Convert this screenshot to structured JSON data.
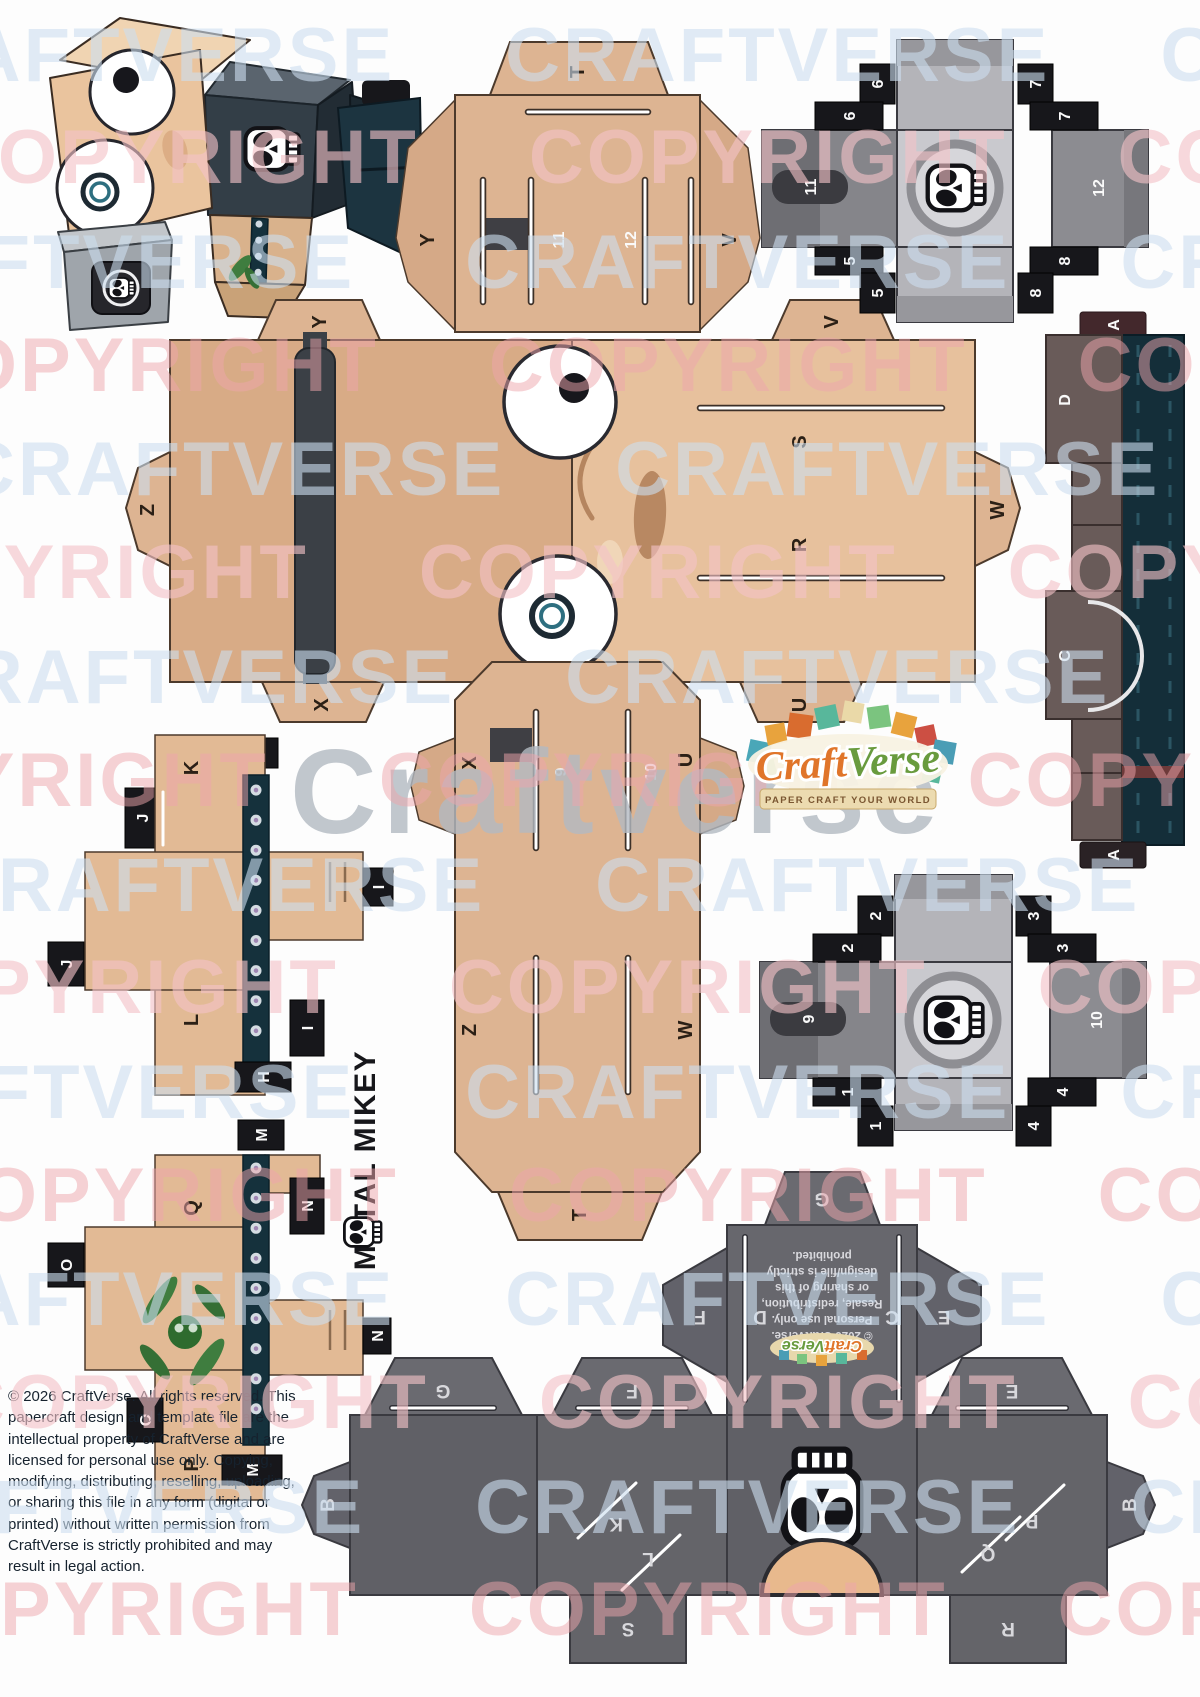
{
  "watermark": {
    "craftverse": "CRAFTVERSE",
    "copyright": "COPYRIGHT",
    "center": "Craftverse"
  },
  "title": "METAL MIKEY",
  "logo": {
    "craft": "Craft",
    "verse": "Verse",
    "tagline": "PAPER CRAFT YOUR WORLD"
  },
  "footer": {
    "copyright": "© 2026 CraftVerse. All rights reserved. This papercraft design and template file are the intellectual property of CraftVerse and are licensed for personal use only. Copying, modifying, distributing, reselling, uploading, or sharing this file in any form (digital or printed) without written permission from CraftVerse is strictly prohibited and may result in legal action."
  },
  "pieces": {
    "head_top": {
      "tab_t": "T",
      "tab_y": "Y",
      "tab_v": "V",
      "slot_11": "11",
      "slot_12": "12"
    },
    "head_band": {
      "tab_t": "T",
      "label_x": "X",
      "label_u": "U",
      "label_z": "Z",
      "label_w": "W",
      "slot_9": "9",
      "slot_10": "10"
    },
    "face": {
      "tab_y": "Y",
      "tab_z": "Z",
      "tab_x": "X",
      "tab_v": "V",
      "tab_u": "U",
      "tab_w": "W",
      "slit_s": "S",
      "slit_r": "R"
    },
    "cube_upper": {
      "slot": "11",
      "right_face": "12",
      "tab_5a": "5",
      "tab_5b": "5",
      "tab_6a": "6",
      "tab_6b": "6",
      "tab_7a": "7",
      "tab_7b": "7",
      "tab_8a": "8",
      "tab_8b": "8"
    },
    "cube_lower": {
      "slot": "9",
      "right_face": "10",
      "tab_1a": "1",
      "tab_1b": "1",
      "tab_2a": "2",
      "tab_2b": "2",
      "tab_3a": "3",
      "tab_3b": "3",
      "tab_4a": "4",
      "tab_4b": "4"
    },
    "strip": {
      "tab_a_top": "A",
      "label_d": "D",
      "label_c": "C",
      "tab_a_bottom": "A"
    },
    "arm_upper": {
      "label_k": "K",
      "label_l": "L",
      "tab_h_top": "H",
      "tab_h_bottom": "H",
      "tab_j_top": "J",
      "tab_j_left": "J",
      "tab_i_right": "I",
      "tab_i_bottom": "I"
    },
    "arm_lower": {
      "label_q": "Q",
      "label_p": "P",
      "tab_m_top": "M",
      "tab_m_bottom": "M",
      "tab_n_left": "N",
      "tab_n_right": "N",
      "tab_o_left": "O",
      "tab_o_bottom": "O"
    },
    "body": {
      "tab_g": "G",
      "flap_g": "G",
      "flap_f": "F",
      "side_f": "F",
      "flap_e": "E",
      "side_e": "E",
      "label_d": "D",
      "label_c": "C",
      "tab_b_left": "B",
      "tab_b_right": "B",
      "slit_k": "K",
      "slit_l": "L",
      "slit_p": "P",
      "slit_q": "Q",
      "ext_s": "S",
      "ext_r": "R",
      "license": [
        "© 2026 CraftVerse.",
        "Personal use only.",
        "Resale, redistribution,",
        "or sharing of this",
        "design/file is strictly",
        "prohibited."
      ]
    }
  }
}
